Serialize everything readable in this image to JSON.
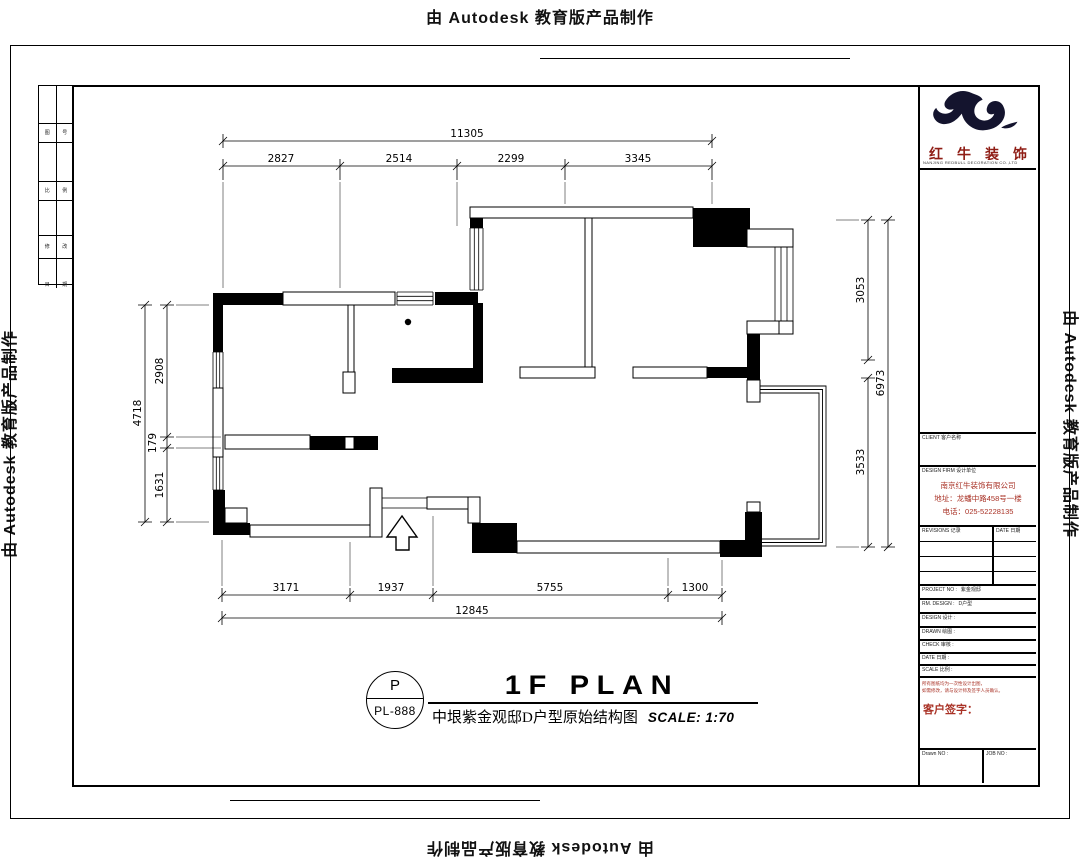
{
  "watermark": "由 Autodesk 教育版产品制作",
  "plan": {
    "dims": {
      "top_total": "11305",
      "top_segments": [
        "2827",
        "2514",
        "2299",
        "3345"
      ],
      "left_total": "4718",
      "left_segments": [
        "2908",
        "179",
        "1631"
      ],
      "right_total": "6973",
      "right_segments": [
        "3053",
        "3533"
      ],
      "bottom_total": "12845",
      "bottom_segments": [
        "3171",
        "1937",
        "5755",
        "1300"
      ]
    },
    "title": {
      "tag": "P",
      "sheet_no": "PL-888",
      "name": "1F PLAN",
      "subtitle": "中垠紫金观邸D户型原始结构图",
      "scale": "SCALE: 1:70"
    }
  },
  "title_block": {
    "brand_name_chars": [
      "红",
      "牛",
      "装",
      "饰"
    ],
    "brand_tagline": "NANJING REDBULL DECORATION CO.,LTD",
    "label_drawing": "DRAWING TITLE 图名",
    "label_client": "CLIENT 客户名称",
    "label_firm": "DESIGN FIRM 设计单位",
    "company_name": "南京红牛装饰有限公司",
    "company_address": "地址：龙蟠中路458号一楼",
    "company_phone": "电话：025-52228135",
    "rev_col1": "REVISIONS 记录",
    "rev_col2": "DATE 日期",
    "info_rows": [
      {
        "label": "PROJECT NO :",
        "value": "紫金观邸"
      },
      {
        "label": "RM. DESIGN :",
        "value": "D户型"
      },
      {
        "label": "DESIGN 设计 :",
        "value": ""
      },
      {
        "label": "DRAWN 绘图 :",
        "value": ""
      },
      {
        "label": "CHECK 审核 :",
        "value": ""
      },
      {
        "label": "DATE 日期 :",
        "value": ""
      },
      {
        "label": "SCALE 比例 :",
        "value": ""
      }
    ],
    "note_line1": "所有图纸均为一次性设计出图，",
    "note_line2": "如需修改，请与设计师及签字人员确认。",
    "signature_label": "客户签字：",
    "footer_left": "Drawn NO :",
    "footer_right": "JOB NO :"
  },
  "edge_strip": {
    "cells": [
      "图",
      "号",
      "比",
      "例",
      "修",
      "改",
      "日",
      "期"
    ]
  },
  "colors": {
    "brand_red": "#8f1d15",
    "info_red": "#a93226",
    "logo_ink": "#14142e"
  }
}
